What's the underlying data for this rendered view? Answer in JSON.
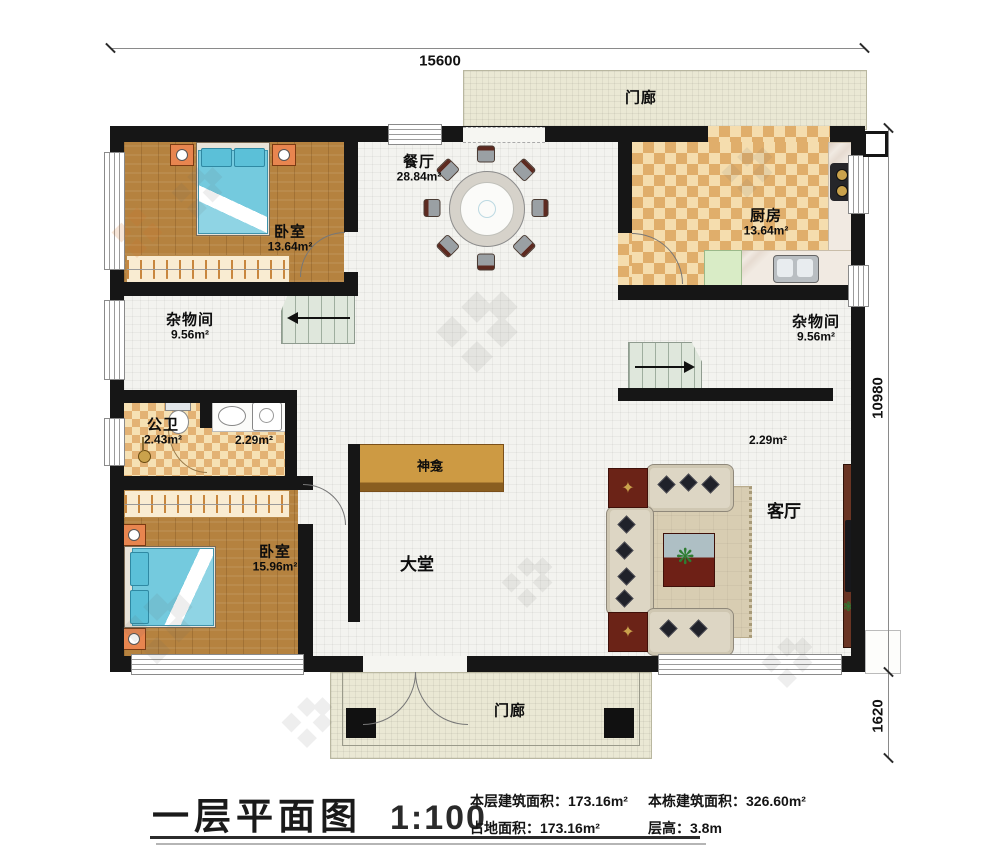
{
  "title": {
    "text": "一层平面图",
    "scale": "1:100"
  },
  "stats": {
    "floor_area": {
      "label": "本层建筑面积：",
      "value": "173.16m²"
    },
    "total_area": {
      "label": "本栋建筑面积：",
      "value": "326.60m²"
    },
    "land_area": {
      "label": "占地面积：",
      "value": "173.16m²"
    },
    "floor_height": {
      "label": "层高：",
      "value": "3.8m"
    }
  },
  "dimensions": {
    "top_width": "15600",
    "right_height": "10980",
    "right_porch": "1620"
  },
  "rooms": {
    "porch_top": {
      "label": "门廊"
    },
    "porch_bottom": {
      "label": "门廊"
    },
    "dining": {
      "label": "餐厅",
      "area": "28.84m²"
    },
    "kitchen": {
      "label": "厨房",
      "area": "13.64m²"
    },
    "bedroom_top": {
      "label": "卧室",
      "area": "13.64m²"
    },
    "storage_left": {
      "label": "杂物间",
      "area": "9.56m²"
    },
    "storage_right": {
      "label": "杂物间",
      "area": "9.56m²"
    },
    "bathroom": {
      "label": "公卫",
      "area": "2.43m²"
    },
    "laundry": {
      "area": "2.29m²"
    },
    "hall_nook": {
      "area": "2.29m²"
    },
    "shrine": {
      "label": "神龛"
    },
    "hall": {
      "label": "大堂"
    },
    "living": {
      "label": "客厅"
    },
    "bedroom_bottom": {
      "label": "卧室",
      "area": "15.96m²"
    }
  },
  "colors": {
    "wall": "#161616",
    "wood_floor": "#b5823f",
    "tile": "#f3f3ef",
    "kitchen_check_dark": "#e0ae6b",
    "kitchen_check_light": "#f5ddae",
    "porch": "#eae8d4",
    "stairs": "#dfe7dc",
    "bed_blue": "#74cade",
    "altar_wood": "#c1873c",
    "sofa_cream": "#ddd6c4",
    "table_red": "#6b2317"
  }
}
